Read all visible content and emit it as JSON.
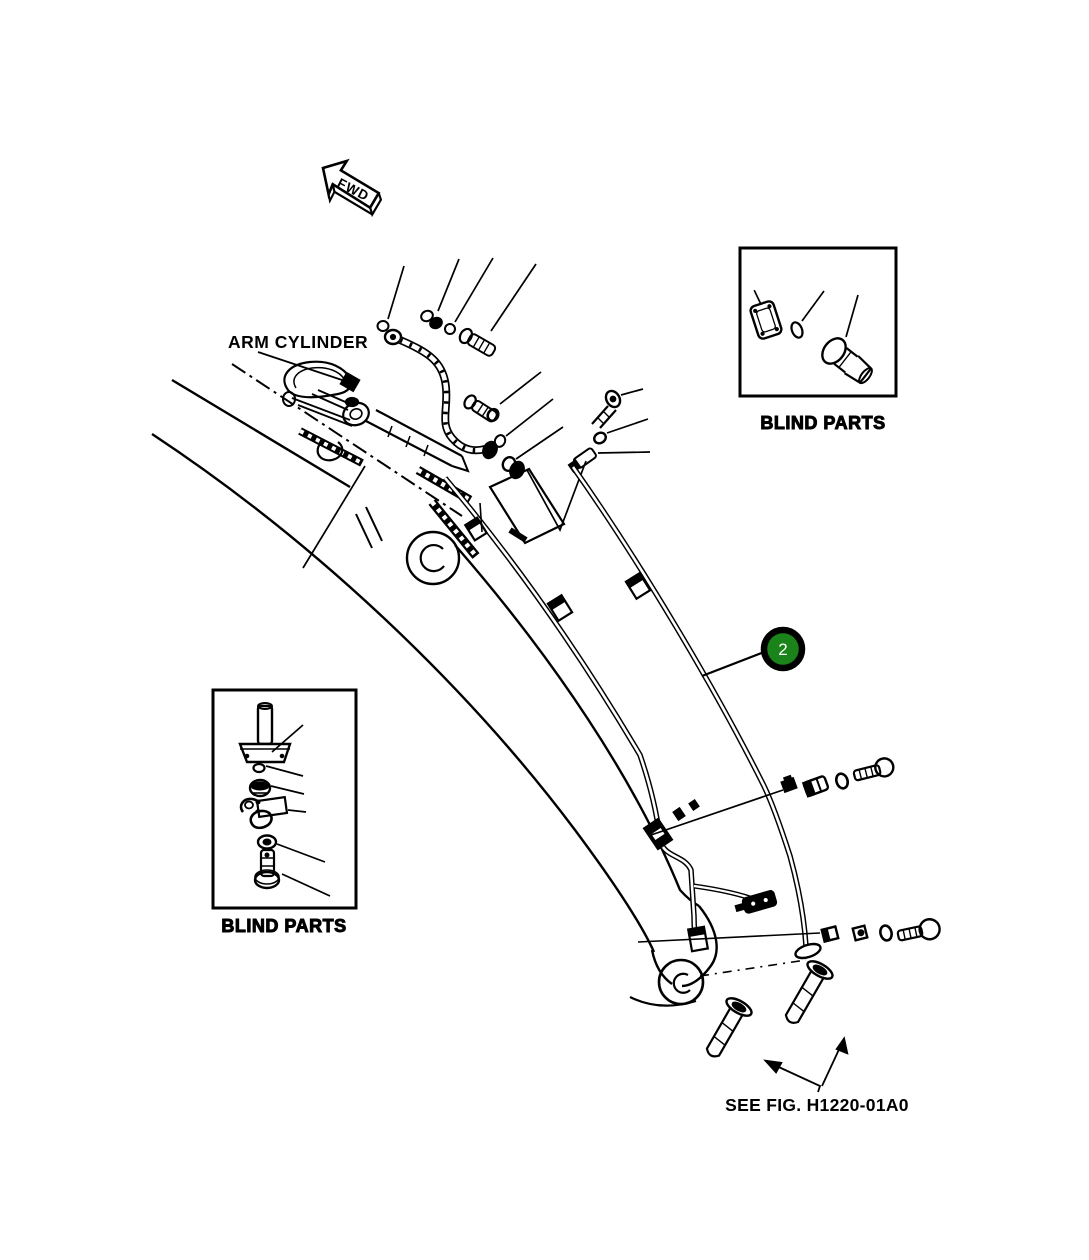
{
  "page": {
    "background": "#ffffff",
    "line_color": "#000000"
  },
  "figure": {
    "direction_arrow": "FWD",
    "labels": {
      "arm_cylinder": "ARM CYLINDER",
      "blind_parts_top": "BLIND PARTS",
      "blind_parts_bottom": "BLIND PARTS",
      "see_fig_ref": "SEE FIG. H1220-01A0"
    },
    "callouts": [
      {
        "number": "2",
        "fill": "#1a841a",
        "ring": "#000000",
        "text_color": "#ffffff"
      }
    ]
  }
}
